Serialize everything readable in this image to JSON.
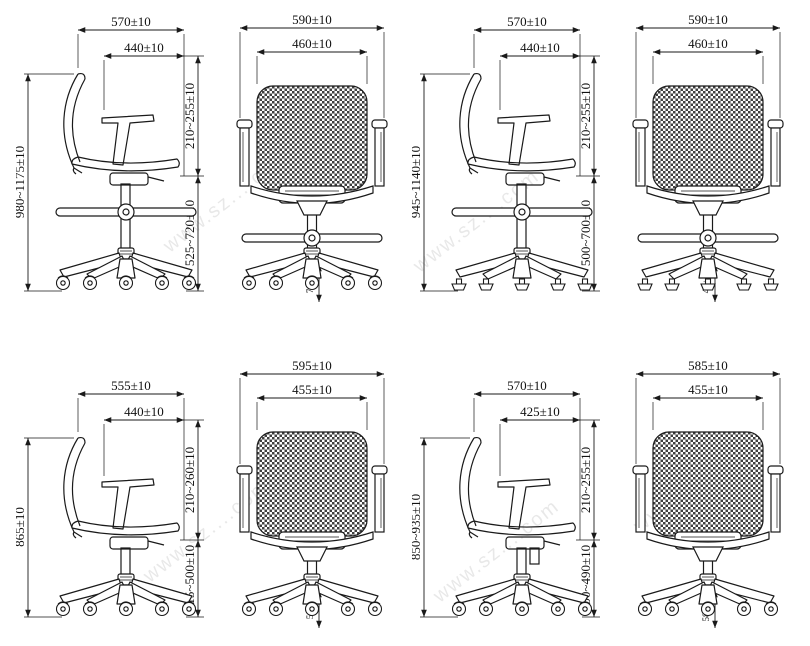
{
  "title": "Office chair dimension drawings",
  "colors": {
    "background": "#ffffff",
    "line": "#1a1a1a",
    "text": "#111111",
    "mesh": "#3f3f3f"
  },
  "watermark": {
    "text": "www.sz....com"
  },
  "figures": [
    {
      "name": "drafting-chair-casters-side",
      "view": "side",
      "footring": true,
      "base": "casters",
      "dims": {
        "overall_depth": "570±10",
        "armrest_width": "440±10",
        "overall_height": "980~1175±10",
        "backrest_height": "210~255±10",
        "seat_height": "525~720±10"
      }
    },
    {
      "name": "drafting-chair-casters-front",
      "view": "front",
      "footring": true,
      "base": "casters",
      "dims": {
        "overall_width": "590±10",
        "backrest_width": "460±10",
        "foot_height": "70±5"
      }
    },
    {
      "name": "drafting-chair-glides-side",
      "view": "side",
      "footring": true,
      "base": "glides",
      "dims": {
        "overall_depth": "570±10",
        "armrest_width": "440±10",
        "overall_height": "945~1140±10",
        "backrest_height": "210~255±10",
        "seat_height": "500~700±10"
      }
    },
    {
      "name": "drafting-chair-glides-front",
      "view": "front",
      "footring": true,
      "base": "glides",
      "dims": {
        "overall_width": "590±10",
        "backrest_width": "460±10",
        "foot_height": "40±5"
      }
    },
    {
      "name": "task-chair-a-side",
      "view": "side",
      "footring": false,
      "base": "casters",
      "dims": {
        "overall_depth": "555±10",
        "armrest_width": "440±10",
        "overall_height": "865±10",
        "backrest_height": "210~260±10",
        "seat_height": "415~500±10"
      }
    },
    {
      "name": "task-chair-a-front",
      "view": "front",
      "footring": false,
      "base": "casters",
      "dims": {
        "overall_width": "595±10",
        "backrest_width": "455±10",
        "foot_height": "50±5"
      }
    },
    {
      "name": "task-chair-b-side",
      "view": "side",
      "footring": false,
      "base": "casters",
      "dims": {
        "overall_depth": "570±10",
        "armrest_width": "425±10",
        "overall_height": "850~935±10",
        "backrest_height": "210~255±10",
        "seat_height": "400~490±10"
      }
    },
    {
      "name": "task-chair-b-front",
      "view": "front",
      "footring": false,
      "base": "casters",
      "dims": {
        "overall_width": "585±10",
        "backrest_width": "455±10",
        "foot_height": "58mm"
      }
    }
  ]
}
